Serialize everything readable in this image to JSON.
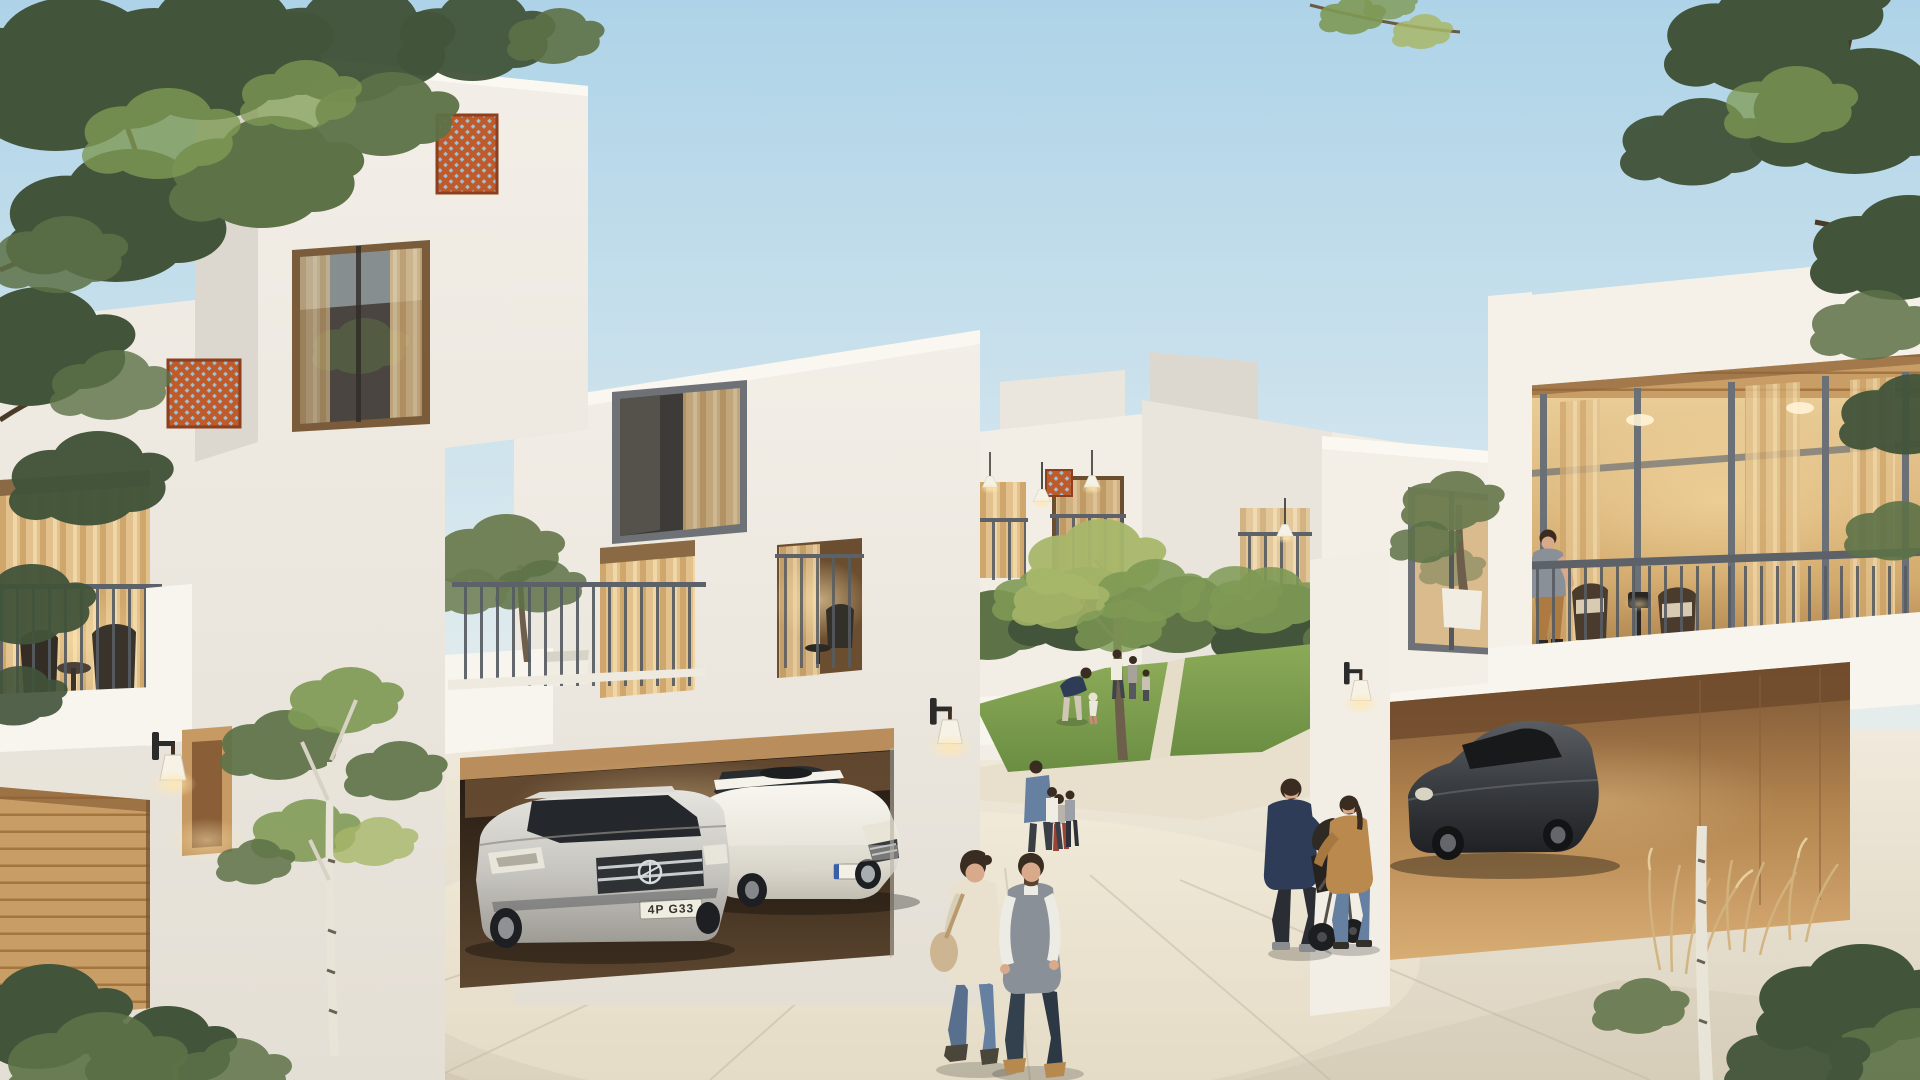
{
  "meta": {
    "description": "Photorealistic 3D architectural rendering of a modern white townhouse community at dusk, with lit interiors, a central landscaped courtyard, garages with parked cars and residents strolling",
    "time_of_day": "dusk"
  },
  "palette": {
    "sky_top": "#aed3e8",
    "sky_mid": "#d6e7ee",
    "sky_low": "#f2f1ea",
    "wall_lit": "#f4f0e8",
    "wall_mid": "#eae6de",
    "wall_shade": "#ddd8cf",
    "parapet": "#f8f5ee",
    "frame_grey": "#6e7276",
    "railing": "#5c6268",
    "glass_dark": "#43423f",
    "lattice": "#bf5a2a",
    "lattice_dark": "#8e3f1d",
    "wood_light": "#d7ab72",
    "wood_mid": "#c1945e",
    "wood_dark": "#9c7344",
    "curtain_warm": "#e7c793",
    "curtain_deep": "#caa369",
    "glow": "#ffe2a8",
    "lawn": "#7fa04e",
    "lawn_dark": "#5f7f3c",
    "leaf_dark": "#42543a",
    "leaf_mid": "#5d7247",
    "leaf_light": "#7f9a55",
    "leaf_yellow": "#a8b86a",
    "olive": "#6c7c50",
    "trunk": "#6e5f4c",
    "birch": "#e9e4d8",
    "grass_dry": "#d2b37e",
    "pave": "#ece5d7",
    "pave_dark": "#d9d1c0",
    "pave_shadow": "#c9c1ae",
    "car_silver": "#c9c7c2",
    "car_white": "#f2efe8",
    "car_dark": "#393c40",
    "skin": "#d9a98c",
    "hair": "#3a2c20",
    "navy": "#2e3c57",
    "denim": "#6580a1",
    "camel": "#b9894d",
    "cream": "#e9e1cd",
    "grey_tee": "#8a9097",
    "tan_pants": "#ad7a42",
    "dark_cloth": "#2a2d33"
  },
  "buildings": {
    "left_villa": {
      "label": "three-storey white villa with orange lattice screens, picture window, furnished balcony, timber garage door and lit entry"
    },
    "center_villa": {
      "label": "white villa with olive-tree balcony, recessed lounge terrace and double garage"
    },
    "right_villa": {
      "label": "white townhouse with timber-ceiling roof terrace, glazed wall and single timber-clad garage"
    },
    "background_row": {
      "label": "rows of white courtyard townhouses with balconies and glowing pendant lamps"
    }
  },
  "vehicles": {
    "mercedes": {
      "label": "silver Mercedes sedan parked in centre garage",
      "license_plate": "4P G33"
    },
    "lexus": {
      "label": "white Lexus sedan parked in centre garage"
    },
    "porsche": {
      "label": "dark grey Porsche coupe parked in right garage"
    }
  },
  "people": {
    "walking_couple": {
      "label": "man in grey vest and woman in cream cardigan walking across the plaza"
    },
    "stroller_family": {
      "label": "man in navy hoodie and woman in camel jacket pushing a dark stroller"
    },
    "balcony_resident": {
      "label": "man in grey t-shirt and tan chinos leaning on terrace railing"
    },
    "courtyard_residents": {
      "label": "families with small children on the courtyard lawn and paths"
    }
  },
  "vegetation": {
    "foreground_trees": {
      "label": "overhanging leafy branches top left and top right"
    },
    "birch": {
      "label": "young birch tree in front of left villa"
    },
    "grasses": {
      "label": "dry ornamental grasses by right garage"
    },
    "courtyard_garden": {
      "label": "lawn, shrubs and small ornamental trees"
    }
  }
}
